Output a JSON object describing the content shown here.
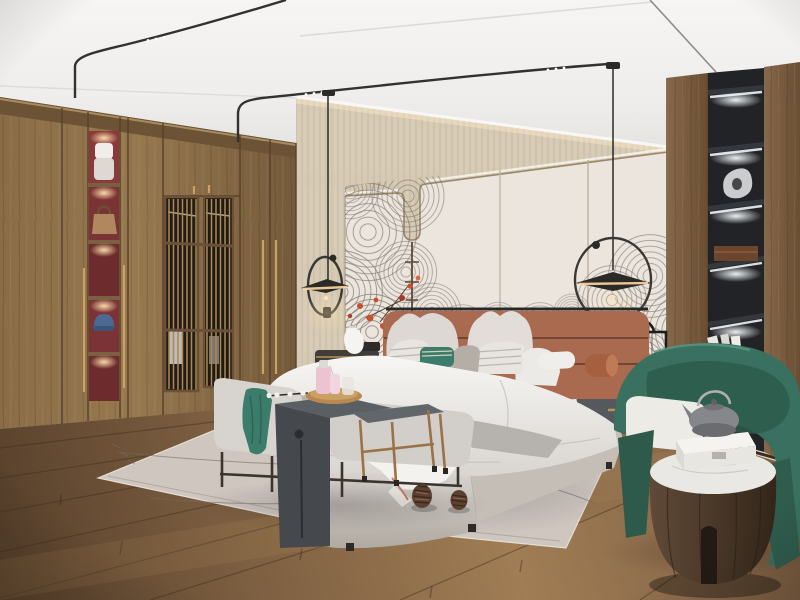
{
  "scene": {
    "description": "Photorealistic render of a modern Japandi-style bedroom: wooden wardrobe wall with lit display niches and lattice doors on the left, upholstered bed with terracotta leather headboard centered on a panelled wall with swirling fan-line artwork and red blossoms, two black disc pendant lamps with circular arms, a grey bench and side tables at the foot of the bed on a pale rug with pinecones, and a green barrel armchair with a round wooden side table beside a black display column on the right.",
    "room": "bedroom",
    "style": "japandi / new chinese",
    "lighting": [
      "warm cove LED above headboard wall",
      "wardrobe niche downlights",
      "display shelf strip lights",
      "two pendant lamps"
    ]
  },
  "objects": [
    {
      "id": "wardrobe",
      "label": "floor-to-ceiling oak wardrobe"
    },
    {
      "id": "display-niches",
      "label": "lit wardrobe niches with towel, handbag and blue cap"
    },
    {
      "id": "lattice-doors",
      "label": "slatted lattice wardrobe doors"
    },
    {
      "id": "ceiling-tracks",
      "label": "black ceiling light tracks with spot dots"
    },
    {
      "id": "pendant-left",
      "label": "black disc pendant lamp with ring arm"
    },
    {
      "id": "pendant-right",
      "label": "black disc pendant lamp with ring arm"
    },
    {
      "id": "grasscloth-wall",
      "label": "beige grasscloth cove wall"
    },
    {
      "id": "artwork",
      "label": "fan-line wave artwork with red blossoms"
    },
    {
      "id": "headboard",
      "label": "terracotta leather headboard"
    },
    {
      "id": "bed",
      "label": "upholstered bed with white duvet, grey blanket and striped throw"
    },
    {
      "id": "pillows",
      "label": "white, striped, grey and teal pillows with bolsters"
    },
    {
      "id": "nightstand-left",
      "label": "dark nightstand with white ceramic vase"
    },
    {
      "id": "nightstand-right",
      "label": "grey capsule nightstand with black lantern lamp"
    },
    {
      "id": "bench",
      "label": "grey bench with teal throw"
    },
    {
      "id": "console-table",
      "label": "dark grey waterfall console with tray, perfume bottles and bead garland"
    },
    {
      "id": "side-table-small",
      "label": "small grey side table with brass legs"
    },
    {
      "id": "rug",
      "label": "pale area rug with thin line motif and two pinecones"
    },
    {
      "id": "armchair",
      "label": "green barrel armchair with white cushion"
    },
    {
      "id": "round-table",
      "label": "round walnut drum table with marble top, white box and grey teapot"
    },
    {
      "id": "display-column",
      "label": "black shelf column with sculpture, box and books"
    },
    {
      "id": "wood-wall",
      "label": "walnut panelling on right wall"
    },
    {
      "id": "floor",
      "label": "oak plank floor"
    }
  ],
  "palette": {
    "ceiling": "#f2f1ef",
    "cove_wall": "#d6cab4",
    "panel_wall": "#ece5de",
    "rug": "#cfc6c0",
    "rug_dark_band": "#2a251f",
    "bench_gray": "#d7d3ce",
    "console_dark": "#45494e",
    "nightstand_gray": "#55585d",
    "niche_black": "#212326",
    "niche_red": "#7c3336",
    "teal_accent": "#3b7c6b",
    "chair_green": "#3a7060",
    "chair_green_dark": "#2e5a4b",
    "marble": "#eae8e4",
    "teapot_gray": "#85878a",
    "perfume_pink": "#ecc3d1",
    "artwork_line": "#6f6861",
    "artwork_red": "#c8502f",
    "pendant_black": "#2b2a27",
    "brass": "#b98f58",
    "headboard": "#a96a4f",
    "wood_light": "#8d7150",
    "wood_dark": "#6b5137",
    "floor_mid": "#87684a",
    "cap_blue": "#4a6a94",
    "bag_tan": "#b08860"
  }
}
